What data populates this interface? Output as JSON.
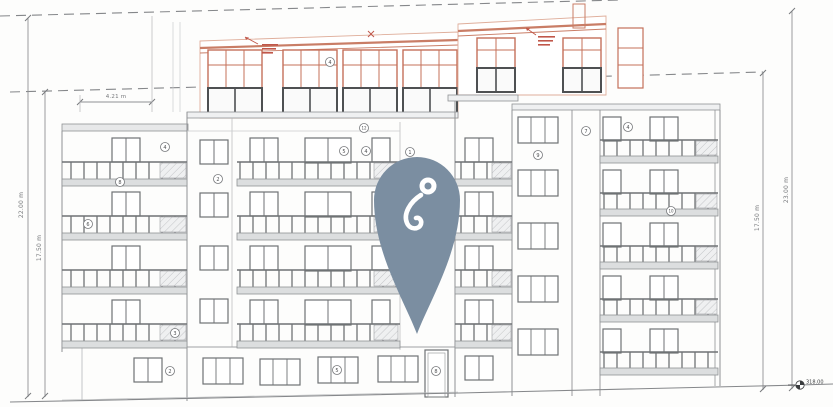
{
  "drawing": {
    "title": "building-elevation-drawing",
    "dimensions": {
      "left_outer": "22.00 m",
      "left_inner": "17.50 m",
      "right_inner": "17.50 m",
      "right_outer": "23.00 m",
      "top_width": "4.21 m"
    },
    "benchmark_level": "318.00",
    "markers": [
      {
        "label": "4"
      },
      {
        "label": "4"
      },
      {
        "label": "8"
      },
      {
        "label": "6"
      },
      {
        "label": "3"
      },
      {
        "label": "2"
      },
      {
        "label": "12"
      },
      {
        "label": "5"
      },
      {
        "label": "4"
      },
      {
        "label": "1"
      },
      {
        "label": "9"
      },
      {
        "label": "7"
      },
      {
        "label": "4"
      },
      {
        "label": "10"
      },
      {
        "label": "2"
      },
      {
        "label": "5"
      },
      {
        "label": "8"
      }
    ],
    "colors": {
      "red_accent": "#c4705a",
      "pin": "#7b8ea1",
      "line": "#8f9194"
    }
  }
}
